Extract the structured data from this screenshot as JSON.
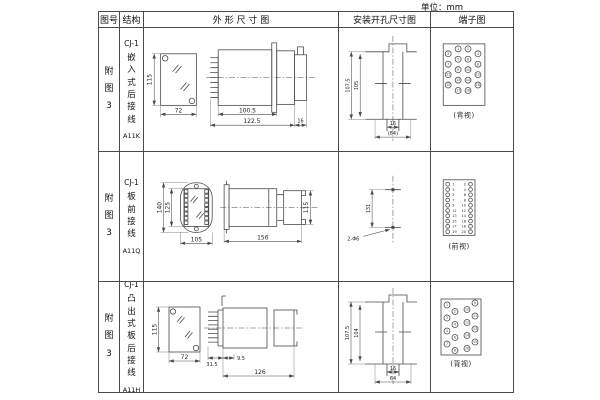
{
  "unit_label": "单位：mm",
  "header": {
    "figure": "图号",
    "structure": "结构",
    "outline": "外 形 尺 寸 图",
    "mounting": "安装开孔尺寸图",
    "terminal": "端子图"
  },
  "rows": [
    {
      "figure": "附图3",
      "model": "CJ-1",
      "structure": "嵌入式后接线",
      "code": "A11K",
      "outline": {
        "front_h": "115",
        "front_w": "72",
        "body_l": "100.5",
        "total_l": "122.5",
        "tail_l": "16"
      },
      "mounting": {
        "outer_h": "107.5",
        "inner_h": "105",
        "slot_w": "16",
        "total_w": "(64)"
      },
      "terminal": {
        "caption": "(背视)",
        "numbers": [
          "1",
          "2",
          "3",
          "4",
          "5",
          "6",
          "7",
          "8",
          "9",
          "10",
          "11",
          "12",
          "13",
          "14",
          "15",
          "16",
          "17",
          "18"
        ]
      }
    },
    {
      "figure": "附图3",
      "model": "CJ-1",
      "structure": "板前接线",
      "code": "A11Q",
      "outline": {
        "front_outer_h": "140",
        "front_inner_h": "125",
        "front_w": "105",
        "side_l": "156",
        "side_h": "115"
      },
      "mounting": {
        "hole_dist": "131",
        "hole_label": "2-Φ6"
      },
      "terminal": {
        "caption": "(前视)",
        "left_numbers": [
          "1",
          "3",
          "5",
          "7",
          "9",
          "11",
          "13",
          "15",
          "17",
          "19"
        ],
        "right_numbers": [
          "2",
          "4",
          "6",
          "8",
          "10",
          "12",
          "14",
          "16",
          "18",
          "20"
        ]
      }
    },
    {
      "figure": "附图3",
      "model": "CJ-1",
      "structure": "凸出式板后接线",
      "code": "A11H",
      "outline": {
        "front_h": "115",
        "front_w": "72",
        "comb_l": "31.5",
        "gap_l": "9.5",
        "total_l": "126"
      },
      "mounting": {
        "outer_h": "107.5",
        "inner_h": "104",
        "slot_w": "16",
        "total_w": "64"
      },
      "terminal": {
        "caption": "(背视)",
        "numbers": [
          "1",
          "2",
          "3",
          "4",
          "5",
          "6",
          "7",
          "8",
          "9",
          "10",
          "11",
          "12",
          "13",
          "14",
          "15",
          "16"
        ]
      }
    }
  ]
}
